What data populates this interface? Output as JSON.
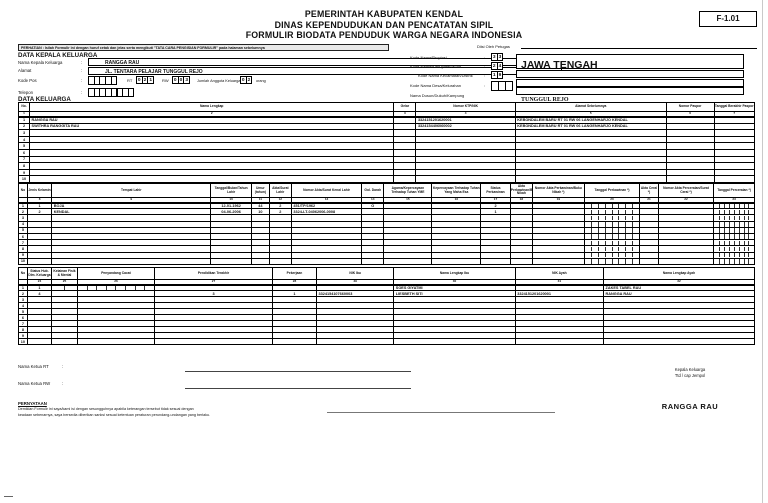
{
  "header": {
    "title_lines": [
      "PEMERINTAH KABUPATEN KENDAL",
      "DINAS KEPENDUDUKAN DAN PENCATATAN SIPIL",
      "FORMULIR BIODATA PENDUDUK WARGA NEGARA INDONESIA"
    ],
    "form_code": "F-1.01",
    "notice": "PERHATIAN : Isilah Formulir ini dengan huruf cetak dan jelas serta mengikuti \"TATA CARA PENGISIAN FORMULIR\" pada halaman sebelumnya"
  },
  "misc": {
    "colon": ":"
  },
  "sections": {
    "kepala_heading": "DATA KEPALA KELUARGA",
    "keluarga_heading": "DATA KELUARGA"
  },
  "kepala": {
    "nama_label": "Nama Kepala Keluarga",
    "nama_value": "RANGGA RAU",
    "alamat_label": "Alamat",
    "alamat_value": "JL. TENTARA PELAJAR TUNGGUL REJO",
    "kodepos_label": "Kode Pos",
    "rt_label": "RT",
    "rt_digits": [
      "0",
      "2",
      "1"
    ],
    "rw_label": "RW",
    "rw_digits": [
      "0",
      "0",
      "3"
    ],
    "jumlah_label": "Jumlah Anggota Keluarga",
    "jumlah_digits": [
      "0",
      "2"
    ],
    "jumlah_suffix": "orang",
    "telepon_label": "Telepon"
  },
  "petugas": {
    "heading": "Diisi Oleh Petugas",
    "rows": [
      {
        "label": "Kode Nama/Propinsi",
        "code_digits": [
          "3",
          "3"
        ],
        "value": "JAWA TENGAH"
      },
      {
        "label": "Kode Nama/Kabupaten/Kota",
        "code_digits": [
          "2",
          "4"
        ],
        "value": "KENDAL"
      },
      {
        "label": "Kode Nama Kecamatan/Distrik",
        "code_digits": [
          "1",
          "9"
        ],
        "value": "KOTA KENDAL"
      },
      {
        "label": "Kode Nama Desa/Kelurahan",
        "code_digits": [
          "",
          "",
          ""
        ],
        "value": "TUNGGUL REJO"
      },
      {
        "label": "Nama Dusun/Dukuh/Kampung",
        "code_digits": [],
        "value": ""
      }
    ]
  },
  "tables": {
    "keluarga": {
      "headers": [
        "No.",
        "Nama Lengkap",
        "Gelar",
        "Nomor KTP/NIK",
        "Alamat Sebelumnya",
        "Nomor Paspor",
        "Tanggal Berakhir Paspor"
      ],
      "col_numbers": [
        "1",
        "2",
        "3",
        "4",
        "5",
        "6",
        "7"
      ],
      "rows": [
        [
          "1",
          "RANGGA RAU",
          "",
          "3324151201620001",
          "KEBONDALEM BARU RT 01 RW 06 LANGENHARJO KENDAL",
          "",
          ""
        ],
        [
          "2",
          "SWITHRA RANGGITA RAU",
          "",
          "3324154406060002",
          "KEBONDALEM BARU RT 01 RW 06 LANGENHARJO KENDAL",
          "",
          ""
        ],
        [
          "3",
          "",
          "",
          "",
          "",
          "",
          ""
        ],
        [
          "4",
          "",
          "",
          "",
          "",
          "",
          ""
        ],
        [
          "5",
          "",
          "",
          "",
          "",
          "",
          ""
        ],
        [
          "6",
          "",
          "",
          "",
          "",
          "",
          ""
        ],
        [
          "7",
          "",
          "",
          "",
          "",
          "",
          ""
        ],
        [
          "8",
          "",
          "",
          "",
          "",
          "",
          ""
        ],
        [
          "9",
          "",
          "",
          "",
          "",
          "",
          ""
        ],
        [
          "10",
          "",
          "",
          "",
          "",
          "",
          ""
        ]
      ]
    },
    "biodata_kelahiran": {
      "headers": [
        "No",
        "Jenis Kelamin",
        "Tempat Lahir",
        "Tanggal/Bulan/Tahun Lahir",
        "Umur (tahun)",
        "Akta/Surat Lahir",
        "Nomor Akta/Surat Kenal Lahir",
        "Gol. Darah",
        "Agama/Kepercayaan Terhadap Tuhan YME",
        "Kepercayaan Terhadap Tuhan Yang Maha Esa",
        "Status Perkawinan",
        "Akta Perkawinan/Buku Nikah",
        "Nomor Akta Perkawinan/Buku Nikah *)",
        "Tanggal Perkawinan *)",
        "Akta Cerai *)",
        "Nomor Akta Perceraian/Surat Cerai *)",
        "Tanggal Perceraian *)"
      ],
      "col_numbers": [
        "",
        "8",
        "9",
        "10",
        "11",
        "12",
        "13",
        "14",
        "15",
        "16",
        "17",
        "18",
        "19",
        "20",
        "21",
        "22",
        "23"
      ],
      "rows": [
        [
          "1",
          "1",
          "BOJA",
          "12-01-1962",
          "44",
          "2",
          "451/TP/1962",
          "O",
          "",
          "",
          "2",
          "",
          "",
          "",
          "",
          "",
          ""
        ],
        [
          "2",
          "2",
          "KENDAL",
          "04-06-2006",
          "10",
          "2",
          "3324-LT-04062006-0008",
          "",
          "",
          "",
          "1",
          "",
          "",
          "",
          "",
          "",
          ""
        ],
        [
          "3",
          "",
          "",
          "",
          "",
          "",
          "",
          "",
          "",
          "",
          "",
          "",
          "",
          "",
          "",
          "",
          ""
        ],
        [
          "4",
          "",
          "",
          "",
          "",
          "",
          "",
          "",
          "",
          "",
          "",
          "",
          "",
          "",
          "",
          "",
          ""
        ],
        [
          "5",
          "",
          "",
          "",
          "",
          "",
          "",
          "",
          "",
          "",
          "",
          "",
          "",
          "",
          "",
          "",
          ""
        ],
        [
          "6",
          "",
          "",
          "",
          "",
          "",
          "",
          "",
          "",
          "",
          "",
          "",
          "",
          "",
          "",
          "",
          ""
        ],
        [
          "7",
          "",
          "",
          "",
          "",
          "",
          "",
          "",
          "",
          "",
          "",
          "",
          "",
          "",
          "",
          "",
          ""
        ],
        [
          "8",
          "",
          "",
          "",
          "",
          "",
          "",
          "",
          "",
          "",
          "",
          "",
          "",
          "",
          "",
          "",
          ""
        ],
        [
          "9",
          "",
          "",
          "",
          "",
          "",
          "",
          "",
          "",
          "",
          "",
          "",
          "",
          "",
          "",
          "",
          ""
        ],
        [
          "10",
          "",
          "",
          "",
          "",
          "",
          "",
          "",
          "",
          "",
          "",
          "",
          "",
          "",
          "",
          "",
          ""
        ]
      ]
    },
    "biodata_ortu": {
      "headers": [
        "No",
        "Status Hub. Dlm. Keluarga",
        "Kelainan Fisik & Mental",
        "Penyandang Cacat",
        "Pendidikan Terakhir",
        "Pekerjaan",
        "NIK Ibu",
        "Nama Lengkap Ibu",
        "NIK Ayah",
        "Nama Lengkap Ayah"
      ],
      "col_numbers": [
        "",
        "24",
        "25",
        "26",
        "27",
        "28",
        "29",
        "30",
        "31",
        "32"
      ],
      "rows": [
        [
          "1",
          "1",
          "",
          "",
          "",
          "",
          "",
          "SOES GIYATMI",
          "",
          "ZAKES TABEL RAU"
        ],
        [
          "2",
          "4",
          "",
          "",
          "3",
          "1",
          "3324154107660003",
          "LIESBETH SITI",
          "3324151201620001",
          "RANGGA RAU"
        ],
        [
          "3",
          "",
          "",
          "",
          "",
          "",
          "",
          "",
          "",
          ""
        ],
        [
          "4",
          "",
          "",
          "",
          "",
          "",
          "",
          "",
          "",
          ""
        ],
        [
          "5",
          "",
          "",
          "",
          "",
          "",
          "",
          "",
          "",
          ""
        ],
        [
          "6",
          "",
          "",
          "",
          "",
          "",
          "",
          "",
          "",
          ""
        ],
        [
          "7",
          "",
          "",
          "",
          "",
          "",
          "",
          "",
          "",
          ""
        ],
        [
          "8",
          "",
          "",
          "",
          "",
          "",
          "",
          "",
          "",
          ""
        ],
        [
          "9",
          "",
          "",
          "",
          "",
          "",
          "",
          "",
          "",
          ""
        ],
        [
          "10",
          "",
          "",
          "",
          "",
          "",
          "",
          "",
          "",
          ""
        ]
      ]
    }
  },
  "bottom": {
    "ketua_rt_label": "Nama Ketua RT",
    "ketua_rw_label": "Nama Ketua RW",
    "pernyataan_title": "PERNYATAAN",
    "pernyataan_line1": "Demikian Formulir ini saya/kami isi dengan sesungguhnya apabila keterangan tersebut tidak sesuai dengan",
    "pernyataan_line2": "keadaan sebenarnya, saya bersedia diberikan sanksi sesuai ketentuan peraturan perundang-undangan yang berlaku.",
    "signature_role": "Kepala Keluarga",
    "signature_method": "Ttd / cap Jempol",
    "signature_name": "RANGGA RAU"
  }
}
